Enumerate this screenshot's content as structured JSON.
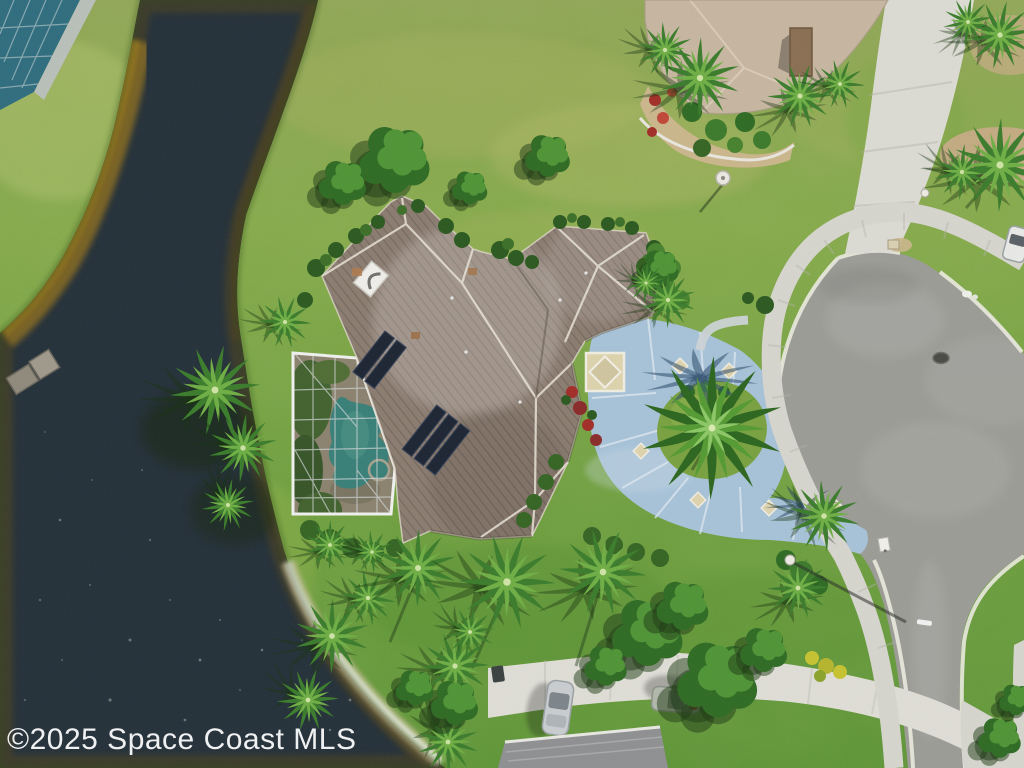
{
  "watermark": {
    "text": "©2025 Space Coast MLS",
    "color": "#ffffff"
  },
  "palette": {
    "water_deep": "#25313a",
    "water_gold": "#8a6d22",
    "water_edge": "#55461c",
    "lawn_light": "#aab365",
    "roof_tile": "#8b7c70",
    "roof_ridge": "#e8e2d6",
    "neighbor_roof": "#c7b7a1",
    "pool_water": "#3f9488",
    "screen_frame": "#f0f0ee",
    "driveway_blue": "#a7c2d8",
    "driveway_inlay": "#ddd3ad",
    "asphalt": "#9c9c97",
    "concrete": "#d6d5ce",
    "concrete_bright": "#dfded6",
    "solar_panel": "#1d2533",
    "palm_green": "#3b7c2c",
    "palm_light": "#6fae45",
    "flower_red": "#a22d28",
    "shadow_blue": "#2b4a6b",
    "foam": "#ffffff"
  }
}
